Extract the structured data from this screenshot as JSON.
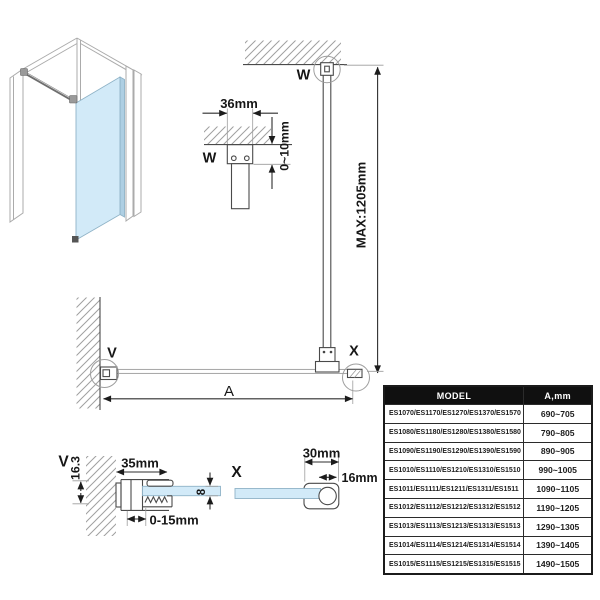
{
  "colors": {
    "glass": "#d2eaf8",
    "glass_edge": "#8fb3c7",
    "line": "#4a4a4a",
    "dimension": "#1c1c1c",
    "table_header_bg": "#101010",
    "table_header_text": "#ffffff"
  },
  "markers": {
    "w": "W",
    "v": "V",
    "x": "X"
  },
  "dimensions": {
    "bracket_width": "36mm",
    "ceiling_adjust": "0~10mm",
    "bar_max_length": "MAX:1205mm",
    "glass_width": "A",
    "wall_profile_depth": "35mm",
    "wall_profile_height": "16.3",
    "profile_adjust": "0-15mm",
    "glass_thickness": "8",
    "clamp_depth": "30mm",
    "bar_diameter": "16mm"
  },
  "table": {
    "headers": [
      "MODEL",
      "A,mm"
    ],
    "rows": [
      {
        "model": "ES1070/ES1170/ES1270/ES1370/ES1570",
        "a": "690~705"
      },
      {
        "model": "ES1080/ES1180/ES1280/ES1380/ES1580",
        "a": "790~805"
      },
      {
        "model": "ES1090/ES1190/ES1290/ES1390/ES1590",
        "a": "890~905"
      },
      {
        "model": "ES1010/ES1110/ES1210/ES1310/ES1510",
        "a": "990~1005"
      },
      {
        "model": "ES1011/ES1111/ES1211/ES1311/ES1511",
        "a": "1090~1105"
      },
      {
        "model": "ES1012/ES1112/ES1212/ES1312/ES1512",
        "a": "1190~1205"
      },
      {
        "model": "ES1013/ES1113/ES1213/ES1313/ES1513",
        "a": "1290~1305"
      },
      {
        "model": "ES1014/ES1114/ES1214/ES1314/ES1514",
        "a": "1390~1405"
      },
      {
        "model": "ES1015/ES1115/ES1215/ES1315/ES1515",
        "a": "1490~1505"
      }
    ]
  }
}
